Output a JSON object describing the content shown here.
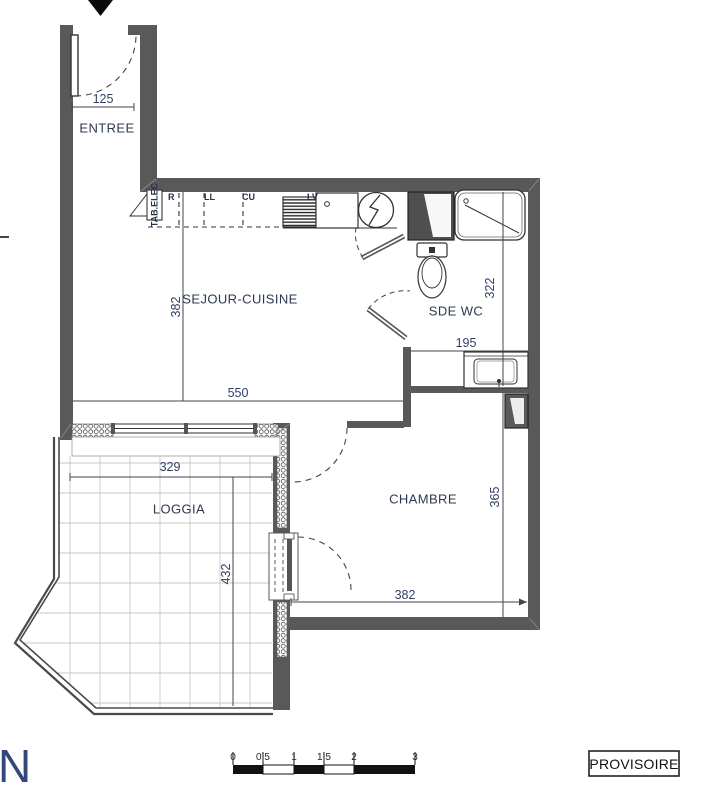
{
  "rooms": {
    "entree": "ENTREE",
    "sejour": "SEJOUR-CUISINE",
    "sde": "SDE WC",
    "chambre": "CHAMBRE",
    "loggia": "LOGGIA"
  },
  "dims": {
    "entree_width": "125",
    "sejour_depth": "382",
    "sejour_width": "550",
    "sde_depth": "322",
    "sde_width": "195",
    "chambre_depth": "365",
    "chambre_width": "382",
    "loggia_width": "329",
    "loggia_depth": "432"
  },
  "kitchen": {
    "tab_elec": "TAB.ELEC",
    "r": "R",
    "ll": "LL",
    "cu": "CU",
    "lv": "LV"
  },
  "scale_bar": {
    "labels": [
      "0",
      "0,5",
      "1",
      "1,5",
      "2",
      "3"
    ]
  },
  "footer": {
    "logo": "N",
    "stamp": "PROVISOIRE"
  },
  "colors": {
    "wall": "#595959",
    "line": "#3f3f3f",
    "room_text": "#2c3850",
    "dim_text": "#2f3f66",
    "logo_blue": "#32477b"
  }
}
